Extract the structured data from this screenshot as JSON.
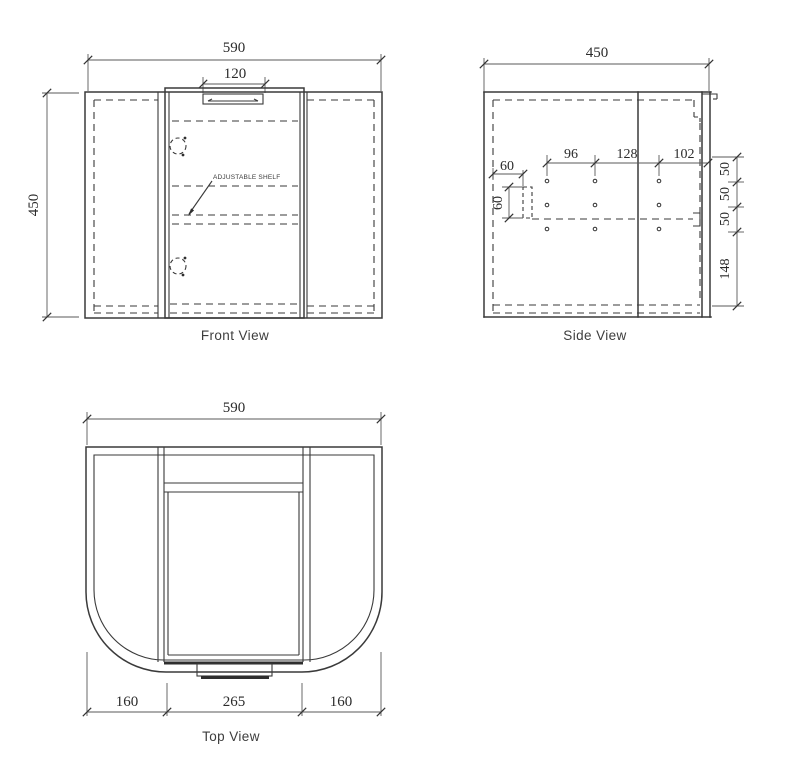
{
  "page": {
    "background": "#ffffff",
    "line_color": "#3a3a3a",
    "dim_text_color": "#2b2b2b"
  },
  "front": {
    "caption": "Front View",
    "width_dim": "590",
    "handle_width_dim": "120",
    "height_dim": "450",
    "shelf_label": "ADJUSTABLE SHELF"
  },
  "side": {
    "caption": "Side View",
    "depth_dim": "450",
    "hole_span_dims": [
      "96",
      "128",
      "102"
    ],
    "bracket_offset_dim": "60",
    "bracket_height_dim": "60",
    "row_spacing_dims": [
      "50",
      "50",
      "50"
    ],
    "bottom_offset_dim": "148"
  },
  "top": {
    "caption": "Top View",
    "width_dim": "590",
    "segment_dims": [
      "160",
      "265",
      "160"
    ]
  }
}
